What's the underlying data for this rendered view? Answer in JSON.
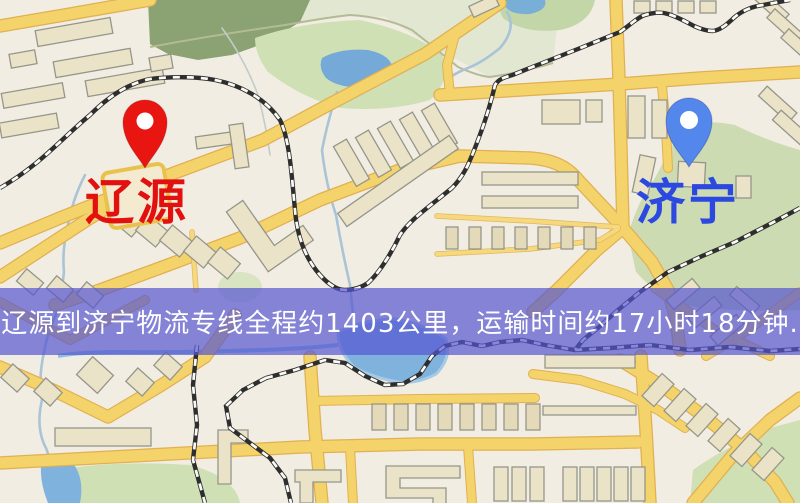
{
  "route_banner": {
    "text": "辽源到济宁物流专线全程约1403公里，运输时间约17小时18分钟.",
    "background_color": "rgba(85,85,210,0.7)",
    "text_color": "#ffffff"
  },
  "route": {
    "origin": "辽源",
    "destination": "济宁",
    "distance_text": "约1403公里",
    "duration_text": "约17小时18分钟"
  },
  "markers": {
    "origin": {
      "label": "辽源",
      "pin_color": "#e81511",
      "label_color": "#e31010"
    },
    "destination": {
      "label": "济宁",
      "pin_color": "#5387ec",
      "label_color": "#2b48e0"
    }
  },
  "map_colors": {
    "background": "#f1ede2",
    "road": "#f5d36b",
    "road_casing": "#e0b052",
    "building": "#ebe3c8",
    "building_outline": "#95968a",
    "railway": "#2e2e2e",
    "water": "#7fb2dc",
    "park": "#ccdbb2",
    "forest": "#8ba273"
  }
}
